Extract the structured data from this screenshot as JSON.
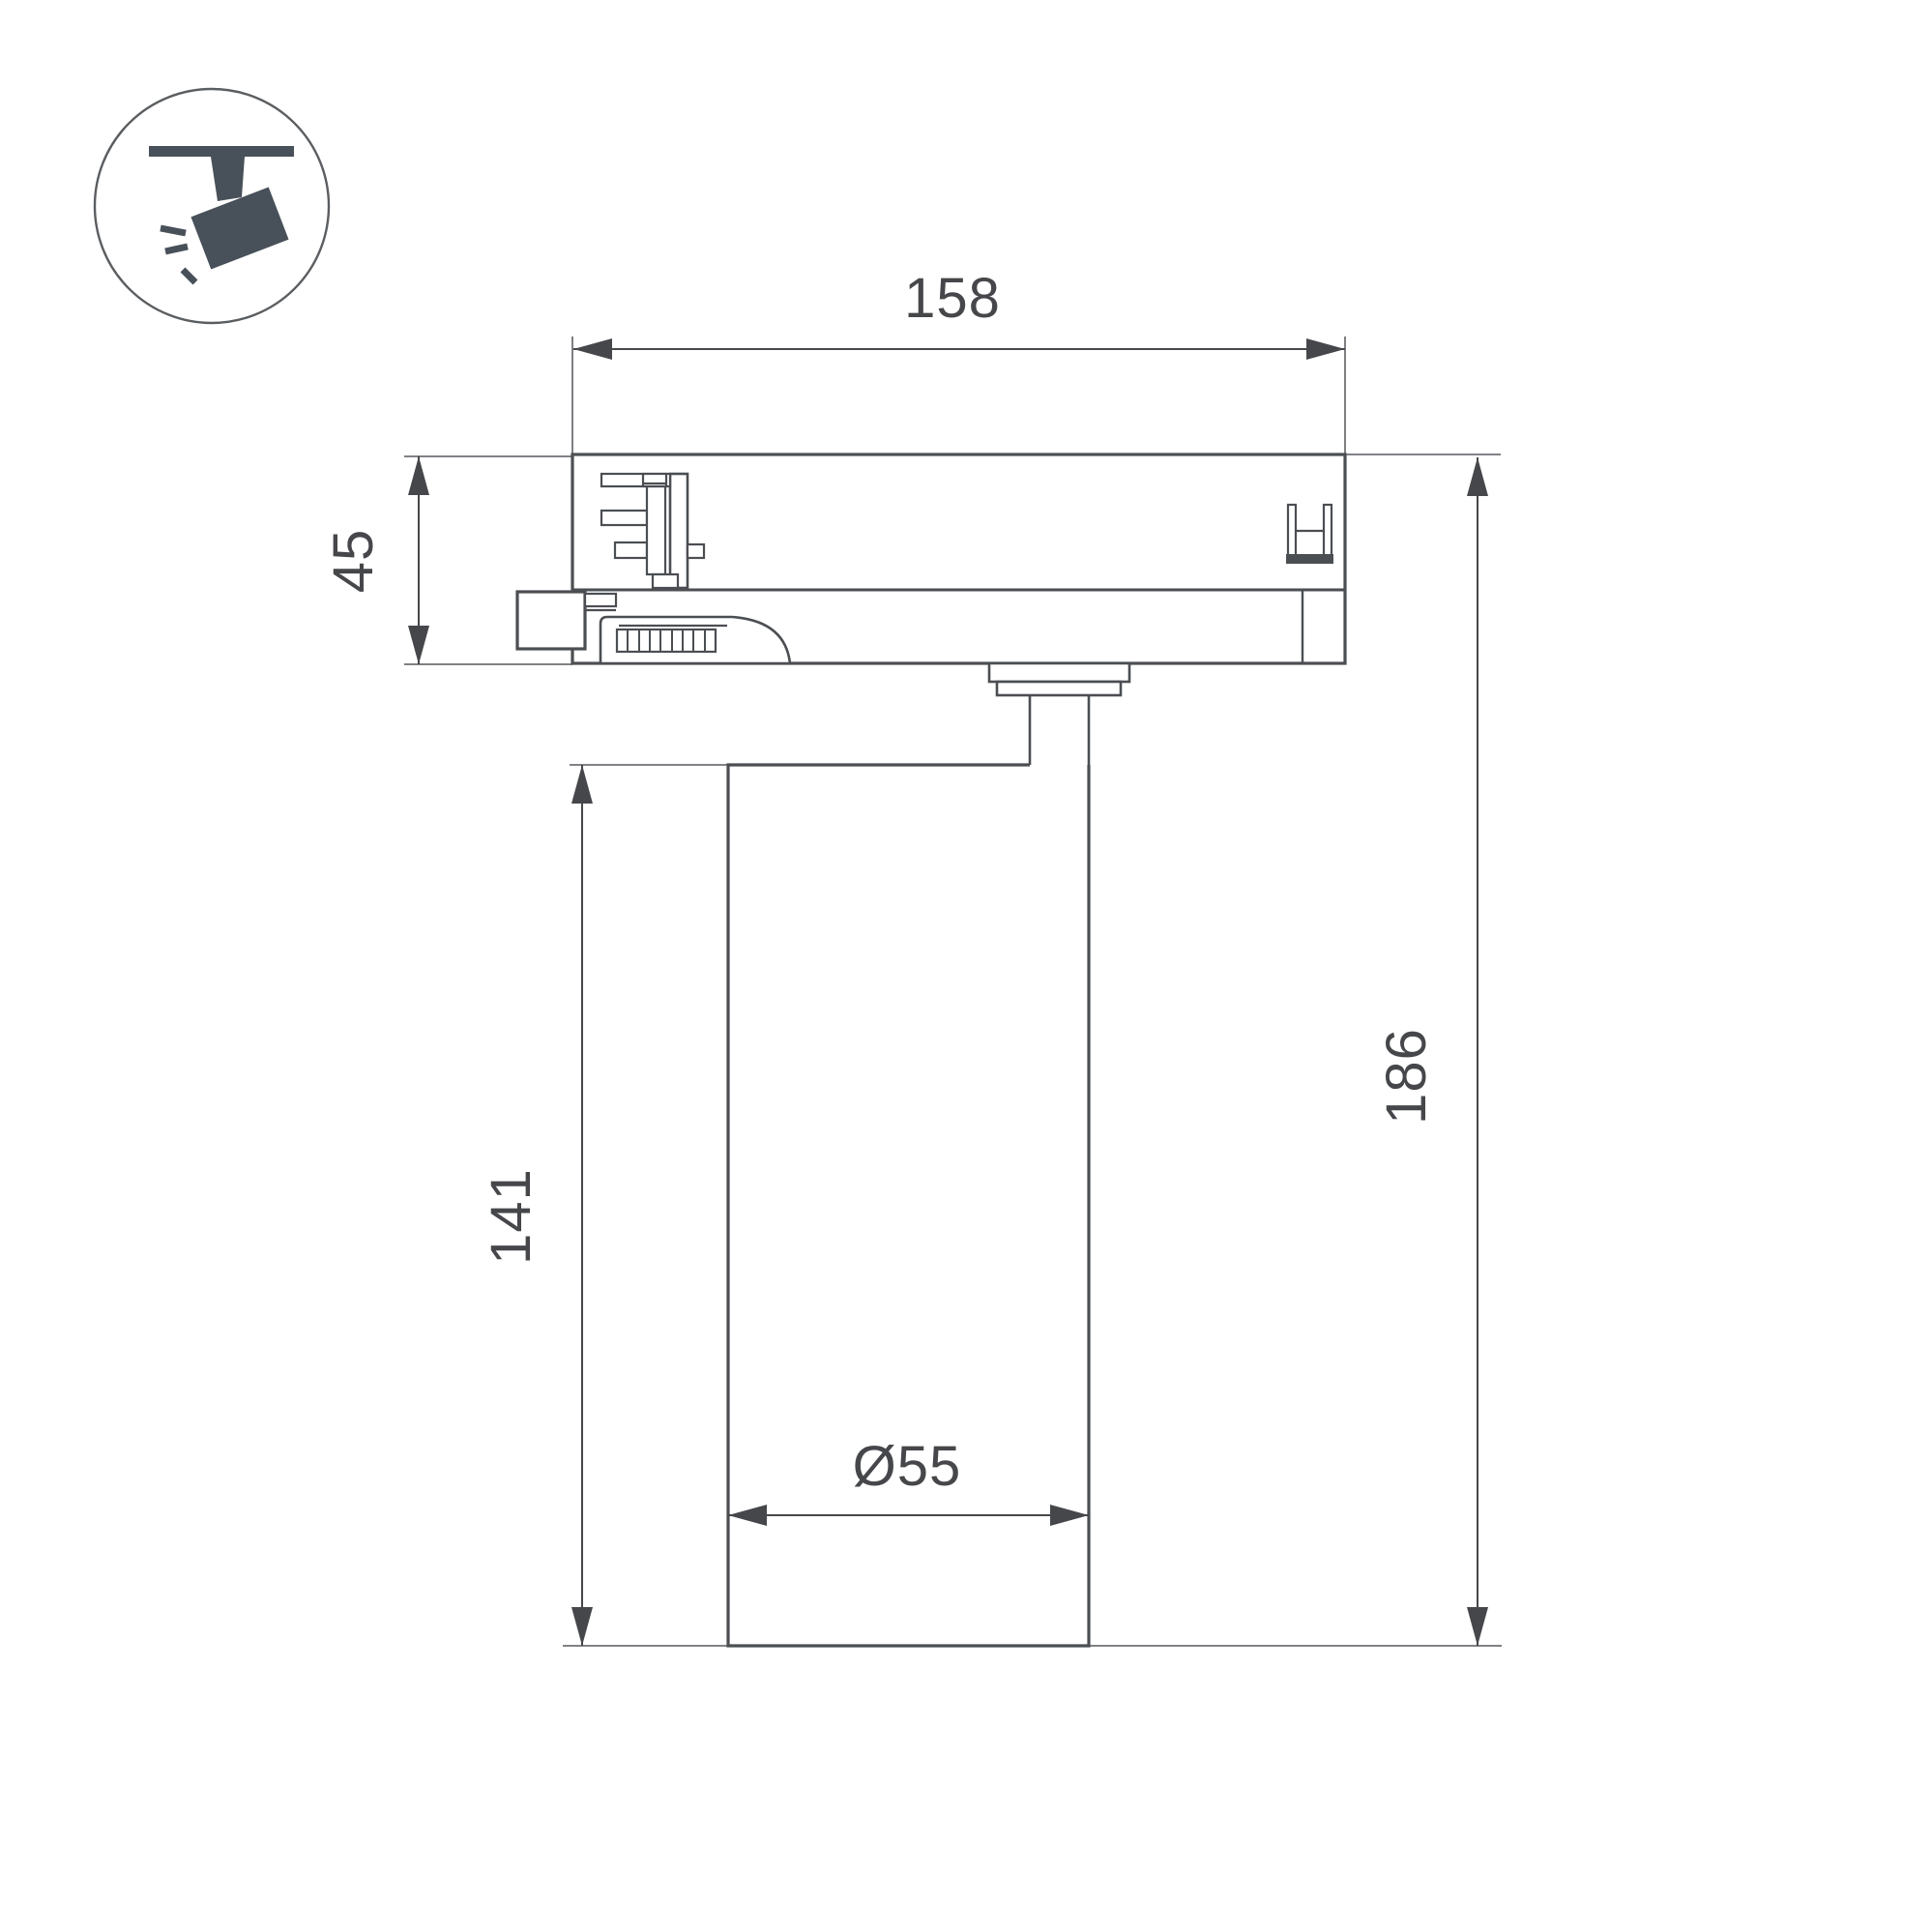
{
  "drawing": {
    "type": "technical-dimension-drawing",
    "subject": "track-mounted spotlight, side view",
    "dimensions": {
      "track_width": "158",
      "adapter_height": "45",
      "body_height": "141",
      "total_height": "186",
      "diameter": "Ø55"
    },
    "icons": {
      "badge": "track-spotlight-icon"
    },
    "colors": {
      "line": "#4b4e52",
      "thin": "#6f7174",
      "text": "#46474a",
      "icon": "#485059",
      "bg": "#ffffff"
    }
  }
}
